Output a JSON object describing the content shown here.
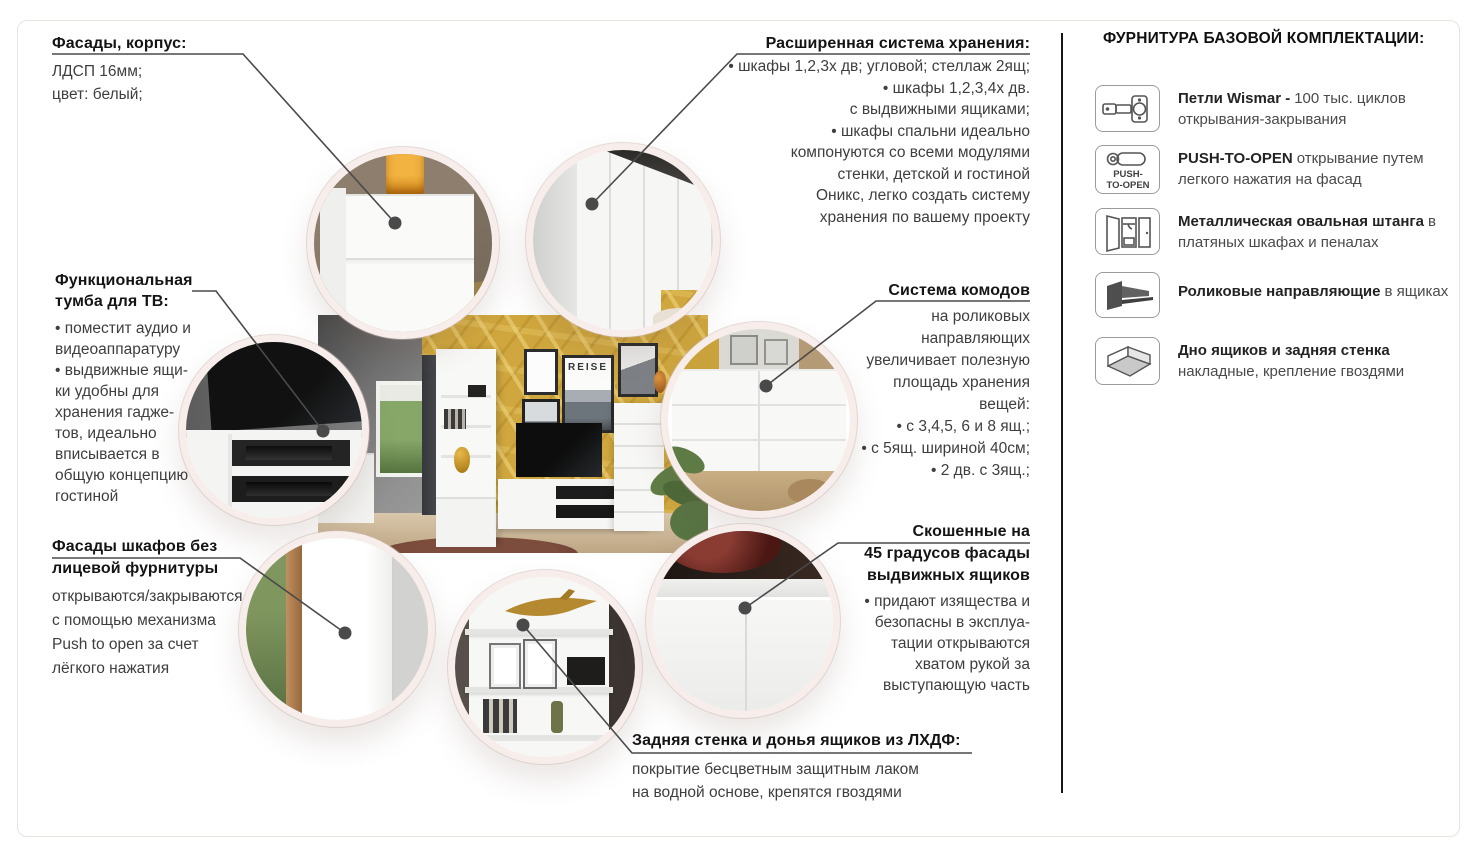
{
  "colors": {
    "accent_wall": "#d0a73e",
    "circle_border": "#f7edeb",
    "callout_line": "#4a4a4a",
    "heading_text": "#141414",
    "body_text": "#3e3e3e"
  },
  "photo": {
    "poster_text": "REISE"
  },
  "callouts": {
    "facades": {
      "title": "Фасады, корпус:",
      "lines": [
        "ЛДСП 16мм;",
        "цвет: белый;"
      ]
    },
    "storage": {
      "title": "Расширенная система хранения:",
      "lines": [
        "• шкафы 1,2,3х дв; угловой; стеллаж 2ящ;",
        "• шкафы 1,2,3,4х дв.",
        "с выдвижными ящиками;",
        "• шкафы спальни идеально",
        "компонуются со всеми модулями",
        "стенки, детской и гостиной",
        "Оникс, легко создать систему",
        "хранения по вашему проекту"
      ]
    },
    "tv": {
      "title1": "Функциональная",
      "title2": "тумба для ТВ:",
      "lines": [
        "• поместит аудио и",
        "видеоаппаратуру",
        "• выдвижные ящи-",
        "ки удобны для",
        "хранения гадже-",
        "тов, идеально",
        "вписывается в",
        "общую концепцию",
        "гостиной"
      ]
    },
    "commodes": {
      "title": "Система комодов",
      "lines": [
        "на роликовых",
        "направляющих",
        "увеличивает полезную",
        "площадь хранения",
        "вещей:",
        "• с 3,4,5, 6 и 8 ящ.;",
        "• с 5ящ. шириной 40см;",
        "• 2 дв. с 3ящ.;"
      ]
    },
    "push_fronts": {
      "title1": "Фасады шкафов без",
      "title2": "лицевой фурнитуры",
      "lines": [
        "открываются/закрываются",
        "с помощью механизма",
        "Push to open за счет",
        "лёгкого нажатия"
      ]
    },
    "beveled": {
      "title1": "Скошенные на",
      "title2": "45 градусов фасады",
      "title3": "выдвижных ящиков",
      "lines": [
        "• придают изящества и",
        "безопасны в эксплуа-",
        "тации открываются",
        "хватом рукой за",
        "выступающую часть"
      ]
    },
    "backwall": {
      "title": "Задняя стенка и донья ящиков из ЛХДФ:",
      "lines": [
        "покрытие бесцветным защитным лаком",
        "на водной основе, крепятся гвоздями"
      ]
    }
  },
  "panel": {
    "title": "ФУРНИТУРА БАЗОВОЙ КОМПЛЕКТАЦИИ:",
    "items": [
      {
        "icon": "hinge-icon",
        "bold": "Петли Wismar -",
        "rest": "100 тыс. циклов открывания-закрывания"
      },
      {
        "icon": "push-to-open-icon",
        "icon_label1": "PUSH-",
        "icon_label2": "TO-OPEN",
        "bold": "PUSH-TO-OPEN",
        "rest": "открывание путем легкого нажатия на фасад"
      },
      {
        "icon": "wardrobe-rod-icon",
        "bold": "Металлическая овальная штанга",
        "rest": "в платяных шкафах и пеналах"
      },
      {
        "icon": "roller-slides-icon",
        "bold": "Роликовые направляющие",
        "rest": "в ящиках"
      },
      {
        "icon": "drawer-bottom-icon",
        "bold": "Дно ящиков и задняя стенка",
        "rest": "накладные, крепление гвоздями"
      }
    ]
  }
}
